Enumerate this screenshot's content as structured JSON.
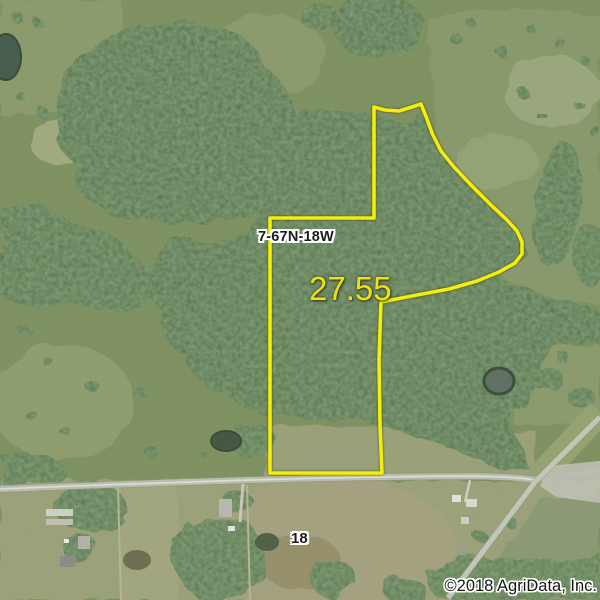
{
  "map": {
    "section_label": "7-67N-18W",
    "acreage": "27.55",
    "road_label": "18",
    "copyright": "©2018 AgriData, Inc.",
    "colors": {
      "parcel_outline": "#f2ef0b",
      "acreage_text": "#f0e30d",
      "forest": "#46633d",
      "pasture": "#7d905e",
      "field_tan": "#9ba178",
      "road": "#bcbfb4"
    }
  }
}
